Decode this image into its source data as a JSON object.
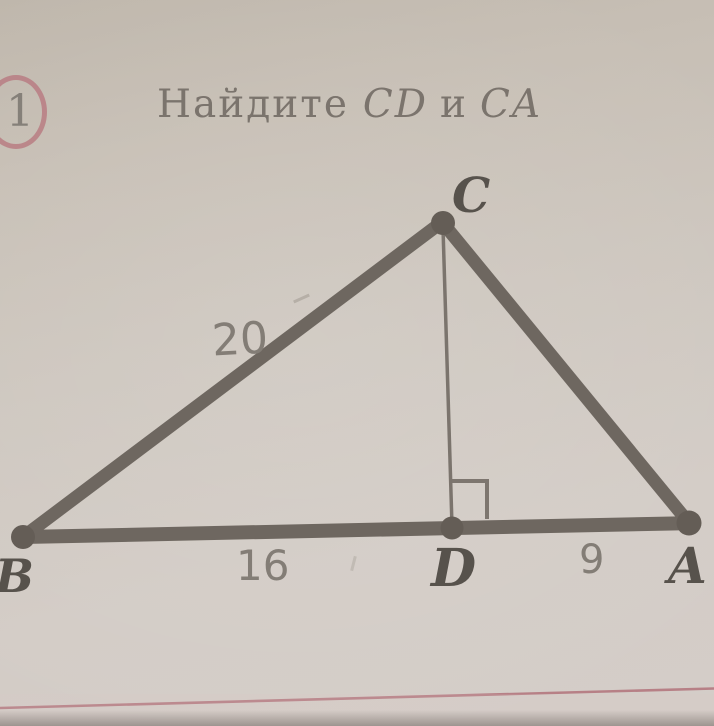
{
  "problem_number": "1",
  "title": {
    "verb": "Найдите",
    "seg1": "CD",
    "conj": "и",
    "seg2": "CA"
  },
  "figure": {
    "vertex_labels": {
      "b": "B",
      "c": "C",
      "d": "D",
      "a": "A"
    },
    "measurements": {
      "bc": "20",
      "bd": "16",
      "da": "9"
    }
  },
  "colors": {
    "paper": "#cdc6be",
    "line_ink": "#6e6760",
    "vertex_dot": "#645d56",
    "label_ink": "#57524c",
    "digit_ink": "#837d76",
    "title_ink": "#7b746d",
    "badge_ring": "#b87c83",
    "ruled_line_red": "#b2737b"
  }
}
